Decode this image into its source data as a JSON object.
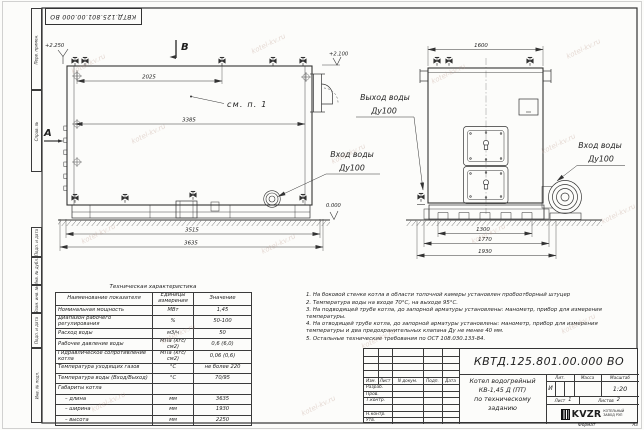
{
  "watermark": {
    "text": "kotel-kv.ru"
  },
  "frame": {
    "stamp_number": "КВТД.125.801.00.000 ВО",
    "side_labels": [
      "Перв. примен.",
      "Справ. №",
      "Подп. и дата",
      "Инв. № дубл.",
      "Взам. инв. №",
      "Подп. и дата",
      "Инв. № подл."
    ],
    "format_label": "Формат",
    "format_value": "А3"
  },
  "drawing": {
    "side_view": {
      "section_b": "В",
      "section_a": "А",
      "level_top": "+2.250",
      "level_right": "+2.100",
      "level_zero": "0.000",
      "dim_top": "2025",
      "dim_mid": "3385",
      "dim_base": "3515",
      "dim_overall": "3635",
      "callout": "см. п. 1",
      "inlet_line1": "Вход воды",
      "inlet_line2": "Ду100"
    },
    "front_view": {
      "dim_width": "1600",
      "dim_base1": "1300",
      "dim_base2": "1770",
      "dim_overall": "1930",
      "outlet_line1": "Выход воды",
      "outlet_line2": "Ду100",
      "inlet_line1": "Вход воды",
      "inlet_line2": "Ду100"
    }
  },
  "spec_table": {
    "title": "Техническая характеристика",
    "col_name": "Наименование показателя",
    "col_units": "Единицы измерения",
    "col_value": "Значение",
    "rows": [
      [
        "Номинальная мощность",
        "МВт",
        "1,45"
      ],
      [
        "Диапазон рабочего регулирования",
        "%",
        "50-100"
      ],
      [
        "Расход воды",
        "м3/ч",
        "50"
      ],
      [
        "Рабочее давление воды",
        "МПа (кгс/см2)",
        "0,6 (6,0)"
      ],
      [
        "Гидравлическое сопротивление котла",
        "МПа (кгс/см2)",
        "0,06 (0,6)"
      ],
      [
        "Температура уходящих газов",
        "°С",
        "не более 220"
      ],
      [
        "Температура воды (Вход/Выход)",
        "°С",
        "70/95"
      ],
      [
        "Габариты котла",
        "",
        ""
      ],
      [
        "– длина",
        "мм",
        "3635"
      ],
      [
        "– ширина",
        "мм",
        "1930"
      ],
      [
        "– высота",
        "мм",
        "2250"
      ]
    ]
  },
  "notes": {
    "items": [
      "1. На боковой стенке котла в области топочной камеры установлен пробоотборный штуцер",
      "2. Температура воды на входе 70°С, на выходе 95°С.",
      "3. На подводящей трубе котла, до запорной арматуры установлены: манометр, прибор для измерения температуры.",
      "4. На отводящей трубе котла, до запорной арматуры установлены: манометр, прибор для измерения температуры и два предохранительных клапана Ду не менее 40 мм.",
      "5. Остальные технические требования по ОСТ 108.030.133-84."
    ]
  },
  "title_block": {
    "doc_number": "КВТД.125.801.00.000 ВО",
    "cols": [
      "Изм.",
      "Лист",
      "N докум.",
      "Подп.",
      "Дата"
    ],
    "rows": [
      "Разраб.",
      "Пров.",
      "Т.контр.",
      "Н.контр.",
      "Утв."
    ],
    "product_line1": "Котел водогрейный",
    "product_line2": "КВ-1,45 Д (ПТ)",
    "product_line3": "по техническому заданию",
    "lit_label": "Лит.",
    "mass_label": "Масса",
    "scale_label": "Масштаб",
    "lit_value": "И",
    "scale_value": "1:20",
    "sheet_label": "Лист",
    "sheet_value": "1",
    "sheets_label": "Листов",
    "sheets_value": "2",
    "logo": "KVZR",
    "logo_line1": "КОТЕЛЬНЫЙ",
    "logo_line2": "ЗАВОД РЭП"
  }
}
